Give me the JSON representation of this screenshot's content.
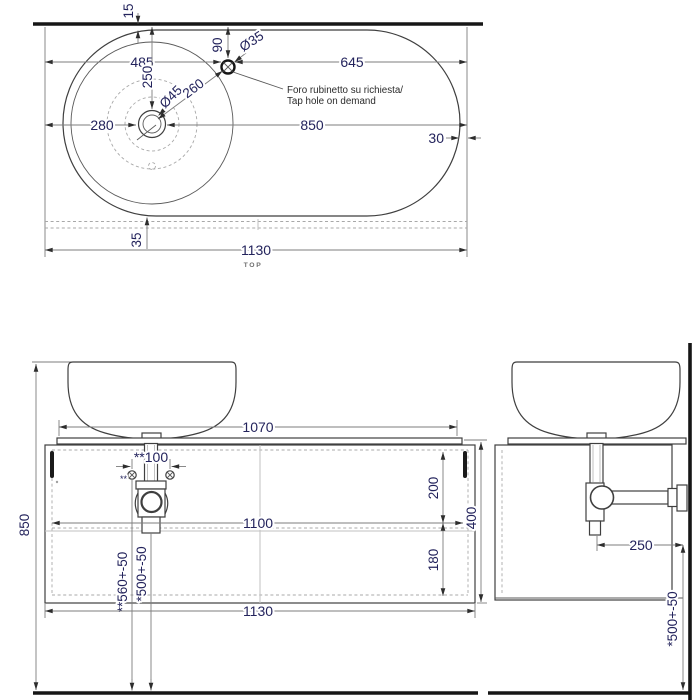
{
  "top_view": {
    "view_label": "TOP",
    "note": {
      "line1": "Foro rubinetto su richiesta/",
      "line2": "Tap hole on demand"
    },
    "dims": {
      "countertop_setback": "15",
      "tap_center_from_wall": "90",
      "tap_hole_diameter": "Ø35",
      "left_edge_to_tap": "485",
      "tap_to_right_edge": "645",
      "basin_center_from_wall": "250",
      "drain_diameter": "Ø45",
      "basin_center_to_tap": "260",
      "left_edge_to_basin_center": "280",
      "basin_center_to_right_edge": "850",
      "right_end_gap": "30",
      "rear_strip_depth": "35",
      "total_width": "1130"
    }
  },
  "front_view": {
    "dims": {
      "floor_to_basin_top": "850",
      "countertop_width": "1070",
      "fixing_hole_spacing": "**100",
      "fixing_marker": "**",
      "carcass_inner_width": "1100",
      "upper_section_height": "200",
      "lower_section_height": "180",
      "cabinet_height": "400",
      "cabinet_width": "1130",
      "waste_left_height": "**560+-50",
      "waste_right_height": "*500+-50"
    }
  },
  "side_view": {
    "dims": {
      "trap_to_wall": "250",
      "waste_outlet_height": "*500+-50"
    }
  }
}
